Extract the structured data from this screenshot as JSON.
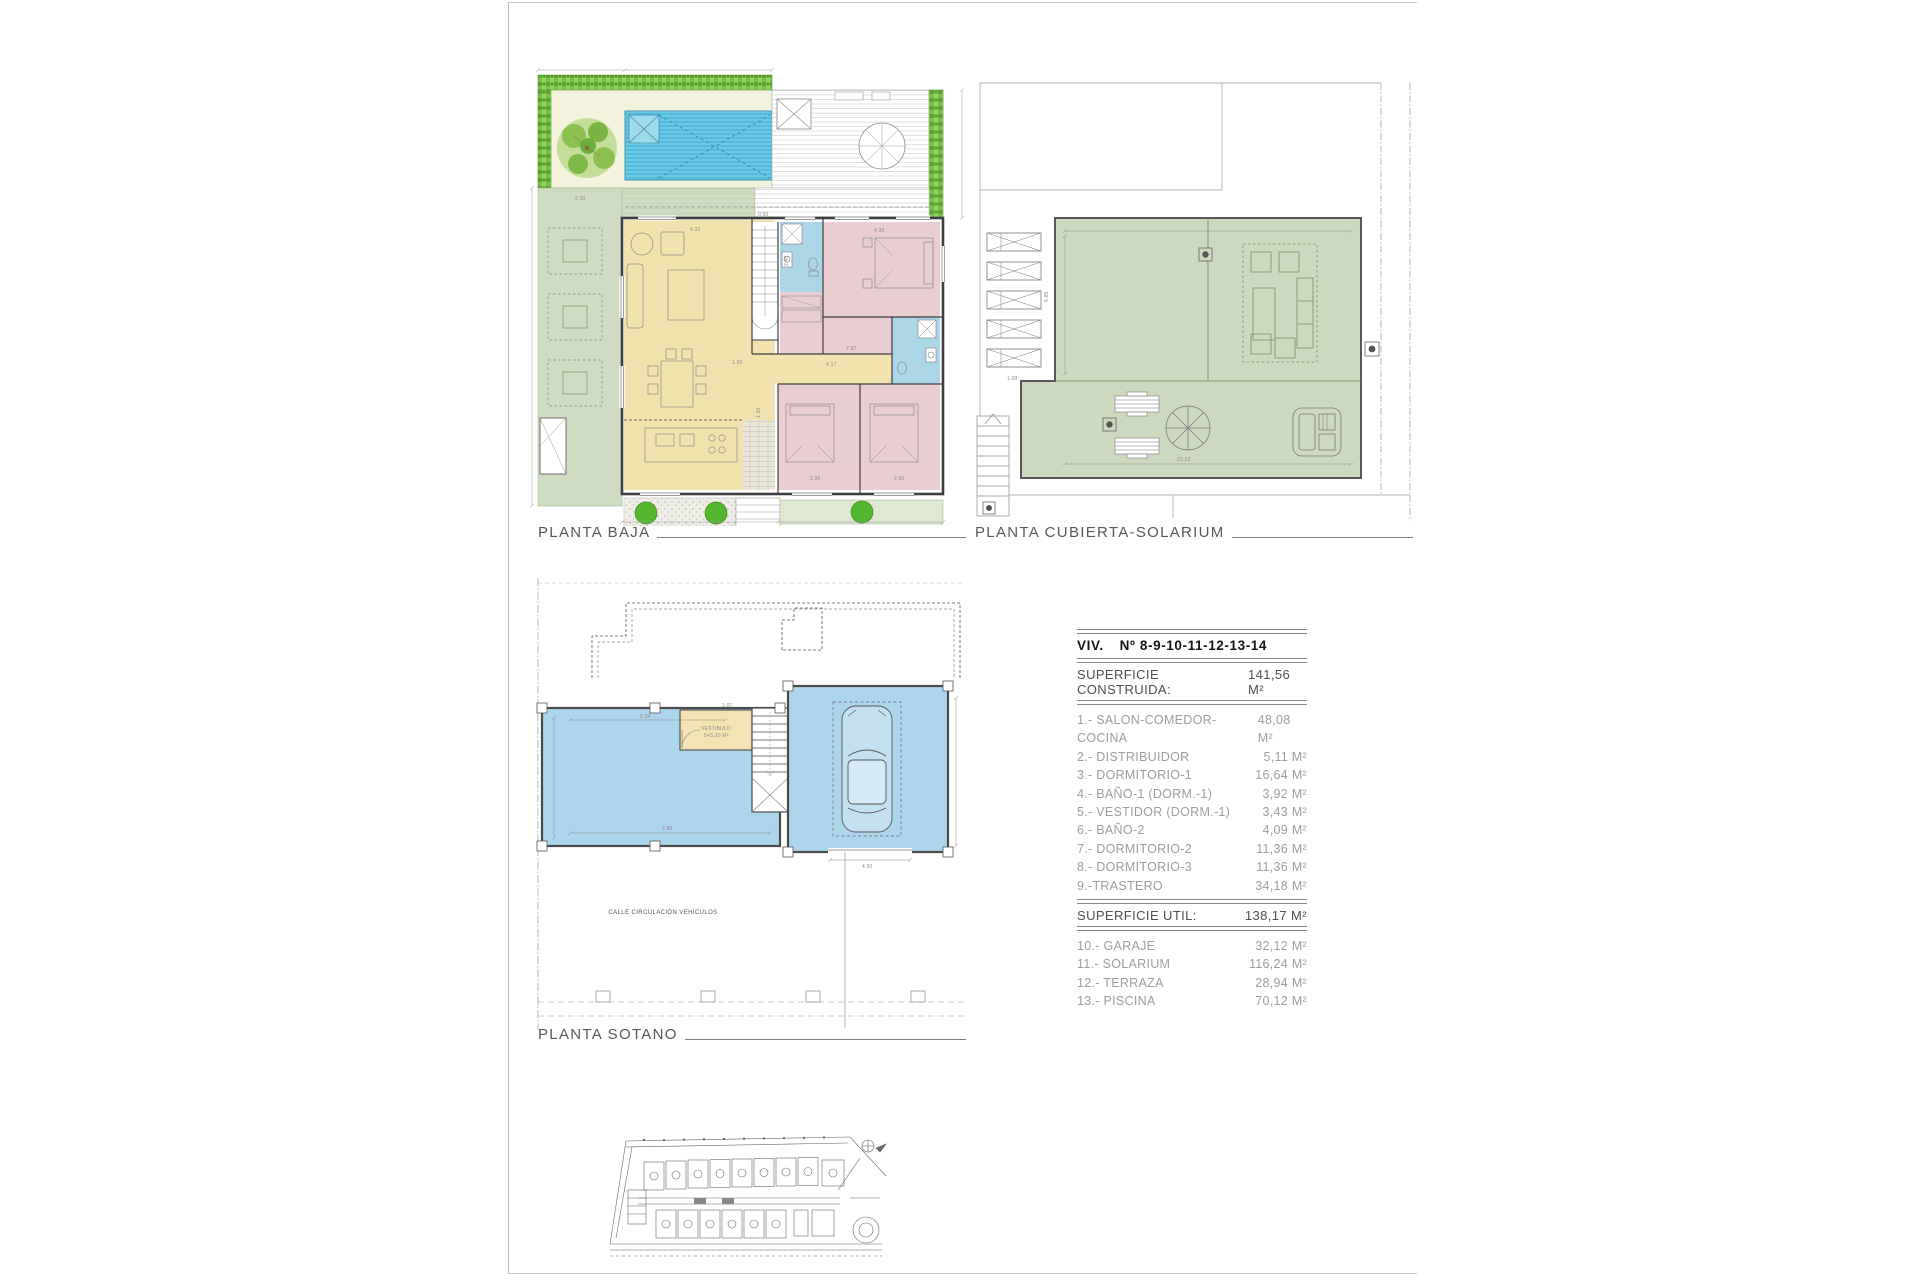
{
  "page": {
    "plan_labels": {
      "planta_baja": "PLANTA BAJA",
      "planta_cubierta": "PLANTA CUBIERTA-SOLARIUM",
      "planta_sotano": "PLANTA SOTANO"
    },
    "table": {
      "title_left": "VIV.",
      "title_right": "Nº 8-9-10-11-12-13-14",
      "construida_label": "SUPERFICIE CONSTRUIDA:",
      "construida_value": "141,56 M²",
      "util_label": "SUPERFICIE UTIL:",
      "util_value": "138,17 M²",
      "items_construida": [
        {
          "label": "1.- SALON-COMEDOR-COCINA",
          "value": "48,08 M²"
        },
        {
          "label": "2.- DISTRIBUIDOR",
          "value": "5,11 M²"
        },
        {
          "label": "3.- DORMITORIO-1",
          "value": "16,64 M²"
        },
        {
          "label": "4.- BAÑO-1 (DORM.-1)",
          "value": "3,92 M²"
        },
        {
          "label": "5.- VESTIDOR (DORM.-1)",
          "value": "3,43 M²"
        },
        {
          "label": "6.- BAÑO-2",
          "value": "4,09 M²"
        },
        {
          "label": "7.- DORMITORIO-2",
          "value": "11,36 M²"
        },
        {
          "label": "8.- DORMITORIO-3",
          "value": "11,36 M²"
        },
        {
          "label": "9.-TRASTERO",
          "value": "34,18 M²"
        }
      ],
      "items_util": [
        {
          "label": "10.- GARAJE",
          "value": "32,12 M²"
        },
        {
          "label": "11.- SOLARIUM",
          "value": "116,24 M²"
        },
        {
          "label": "12.- TERRAZA",
          "value": "28,94 M²"
        },
        {
          "label": "13.- PISCINA",
          "value": "70,12 M²"
        }
      ]
    },
    "plan_texts": {
      "vestibulo_line1": "VESTIBULO",
      "vestibulo_line2": "S=3,20 M²",
      "calle": "CALLE CIRCULACIÓN VEHÍCULOS"
    },
    "dims": {
      "d433": "4.33",
      "d050": "0.50",
      "d245": "2.45",
      "d430": "4.30",
      "d417": "4.17",
      "d100": "1.00",
      "d787": "7.87",
      "d290": "2.90",
      "d150": "1.50",
      "d200": "2.00",
      "c2323": "23.23",
      "c585": "5.85",
      "c100": "1.00",
      "s534": "5.34",
      "s107": "1.07",
      "s280": "2.80",
      "s450": "4.50"
    },
    "palette": {
      "pool_blue": "#53BBDC",
      "hedge_green": "#79C143",
      "terrace_green": "#CFDCC2",
      "solarium_green": "#CDD9BE",
      "room_yellow": "#F2E3AE",
      "room_pink": "#E9CDD1",
      "bath_blue": "#ABD6E8",
      "basement_blue": "#AAD5EA",
      "wall_gray": "#4A4A4C"
    }
  }
}
